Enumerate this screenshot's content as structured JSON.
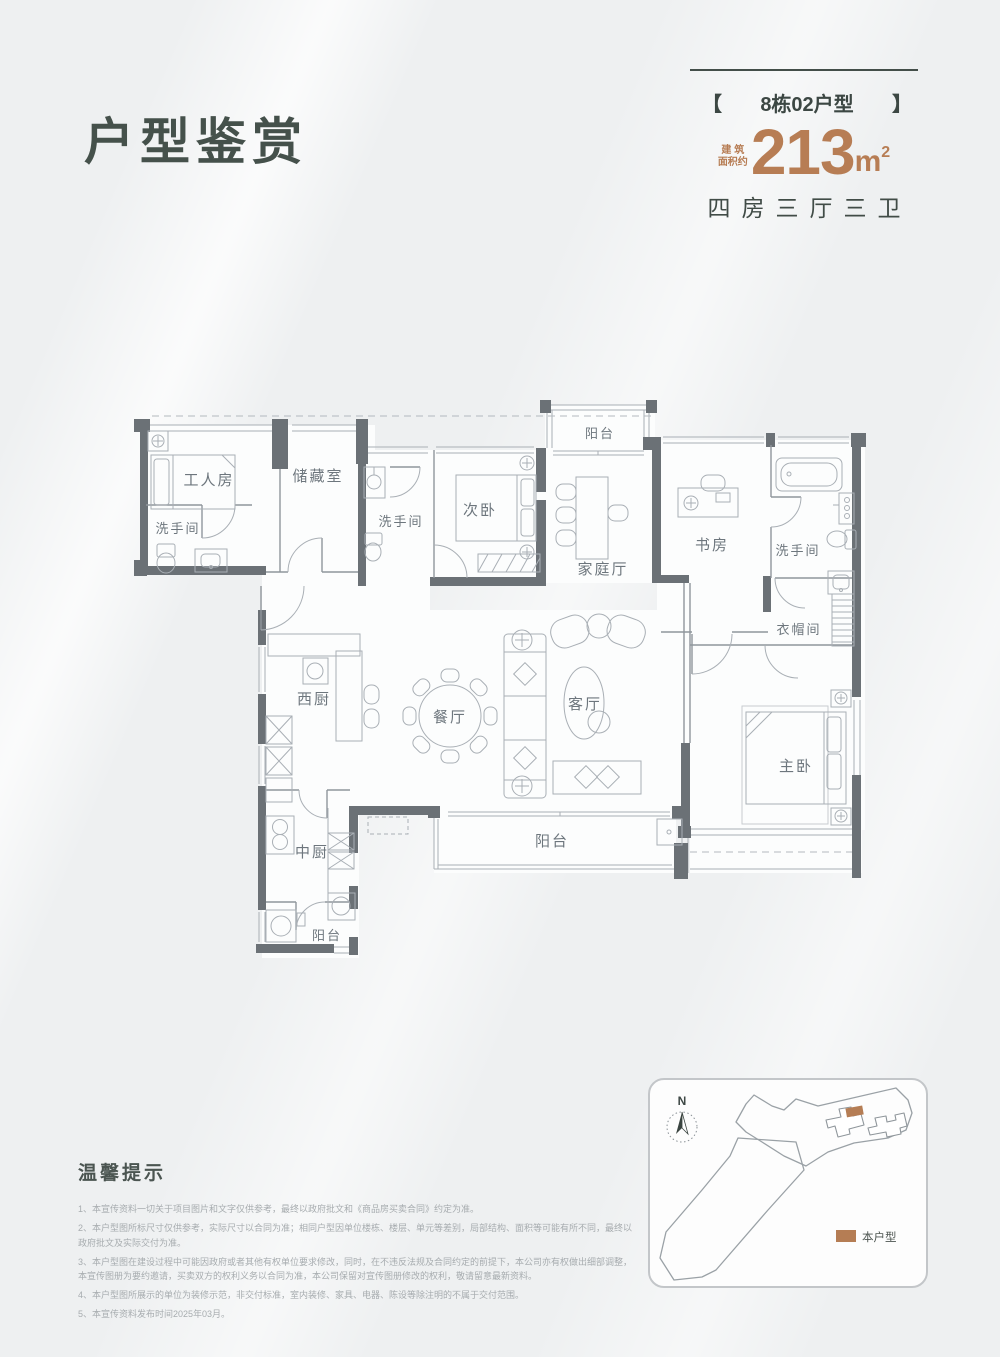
{
  "header": {
    "page_title": "户型鉴赏",
    "unit_tag": {
      "bracket_left": "【",
      "name": "8栋02户型",
      "bracket_right": "】"
    },
    "area": {
      "prefix_top": "建 筑",
      "prefix_bottom": "面积约",
      "value": "213",
      "unit": "m",
      "superscript": "2"
    },
    "layout_summary": "四房三厅三卫"
  },
  "floorplan": {
    "rooms": [
      {
        "id": "worker-room",
        "label": "工人房"
      },
      {
        "id": "storage-room",
        "label": "储藏室"
      },
      {
        "id": "bathroom-left",
        "label": "洗手间"
      },
      {
        "id": "bathroom-middle",
        "label": "洗手间"
      },
      {
        "id": "second-bedroom",
        "label": "次卧"
      },
      {
        "id": "balcony-top",
        "label": "阳台"
      },
      {
        "id": "family-hall",
        "label": "家庭厅"
      },
      {
        "id": "study",
        "label": "书房"
      },
      {
        "id": "bathroom-right",
        "label": "洗手间"
      },
      {
        "id": "cloakroom",
        "label": "衣帽间"
      },
      {
        "id": "west-kitchen",
        "label": "西厨"
      },
      {
        "id": "dining-room",
        "label": "餐厅"
      },
      {
        "id": "living-room",
        "label": "客厅"
      },
      {
        "id": "master-bedroom",
        "label": "主卧"
      },
      {
        "id": "chinese-kitchen",
        "label": "中厨"
      },
      {
        "id": "balcony-south",
        "label": "阳台"
      },
      {
        "id": "balcony-kitchen",
        "label": "阳台"
      }
    ]
  },
  "tips": {
    "heading": "温馨提示",
    "items": [
      "1、本宣传资料一切关于项目图片和文字仅供参考，最终以政府批文和《商品房买卖合同》约定为准。",
      "2、本户型图所标尺寸仅供参考，实际尺寸以合同为准；相同户型因单位楼栋、楼层、单元等差别，局部结构、面积等可能有所不同，最终以政府批文及实际交付为准。",
      "3、本户型图在建设过程中可能因政府或者其他有权单位要求修改，同时，在不违反法规及合同约定的前提下，本公司亦有权做出细部调整，本宣传图册为要约邀请，买卖双方的权利义务以合同为准，本公司保留对宣传图册修改的权利，敬请留意最新资料。",
      "4、本户型图所展示的单位为装修示范，非交付标准，室内装修、家具、电器、陈设等除注明的不属于交付范围。",
      "5、本宣传资料发布时间2025年03月。"
    ]
  },
  "sitemap": {
    "compass_label": "N",
    "legend_label": "本户型"
  },
  "colors": {
    "accent_bronze": "#b77d54",
    "title_green": "#45514b",
    "wall_gray": "#6b7176"
  }
}
